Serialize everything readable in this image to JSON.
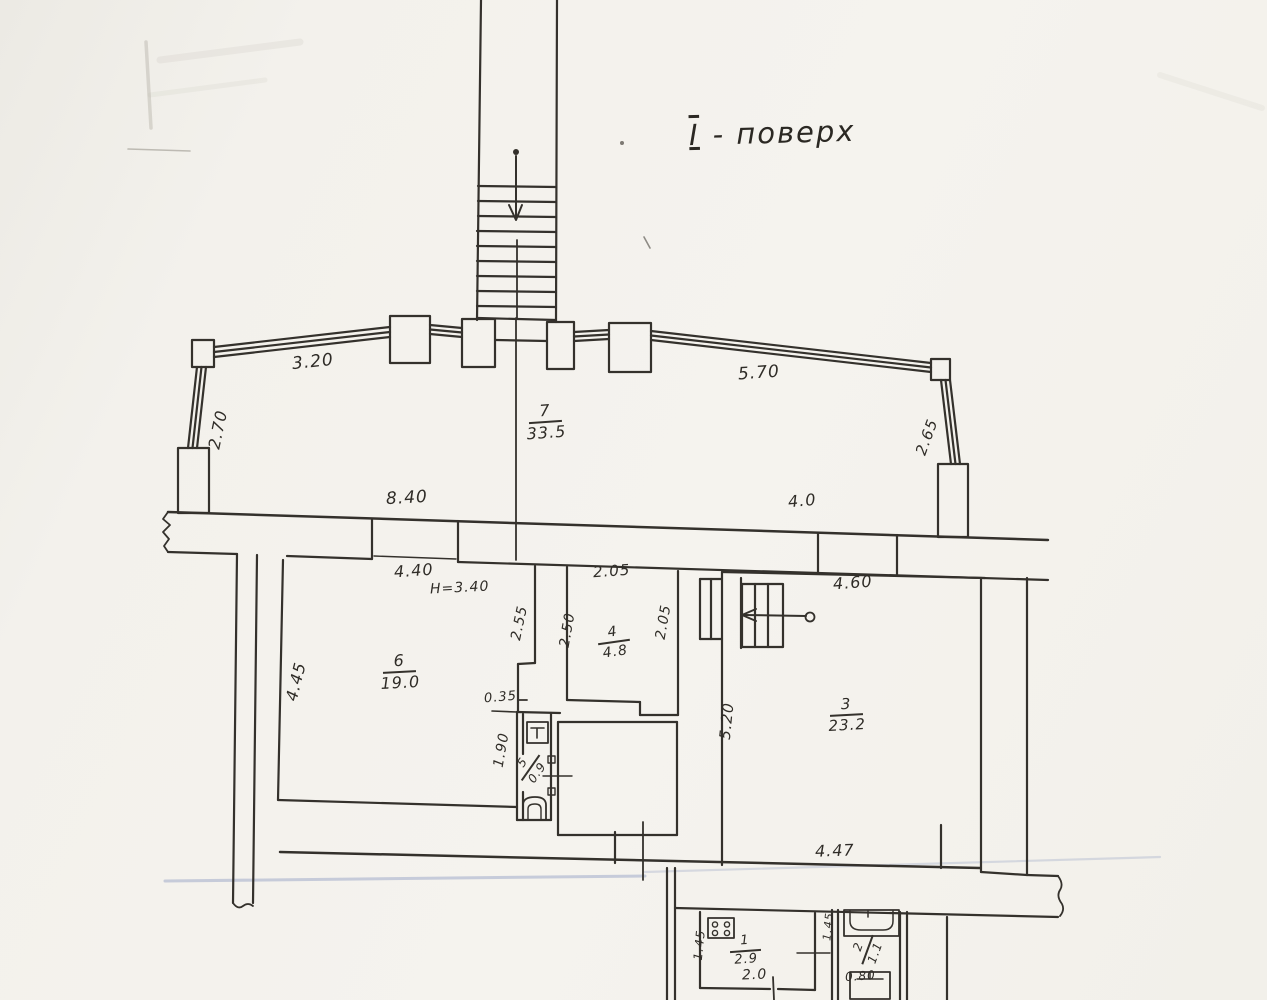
{
  "title": {
    "numeral": "І",
    "text": "- поверх"
  },
  "rooms": {
    "r7": {
      "number": "7",
      "area": "33.5"
    },
    "r6": {
      "number": "6",
      "area": "19.0"
    },
    "r4": {
      "number": "4",
      "area": "4.8"
    },
    "r5": {
      "number": "5",
      "area": "0.9"
    },
    "r3": {
      "number": "3",
      "area": "23.2"
    },
    "r1": {
      "number": "1",
      "area": "2.9"
    },
    "r2": {
      "number": "2",
      "area": "1.1"
    }
  },
  "labels": {
    "d320": "3.20",
    "d570": "5.70",
    "d270": "2.70",
    "d265": "2.65",
    "d840": "8.40",
    "d40": "4.0",
    "d440": "4.40",
    "h340": "H=3.40",
    "d445": "4.45",
    "d255": "2.55",
    "d035": "0.35",
    "d190": "1.90",
    "d205top": "2.05",
    "d250": "2.50",
    "d205right": "2.05",
    "d460": "4.60",
    "d520": "5.20",
    "d447": "4.47",
    "d145left": "1.45",
    "d20": "2.0",
    "d080": "0.80",
    "d145right": "1.45"
  }
}
